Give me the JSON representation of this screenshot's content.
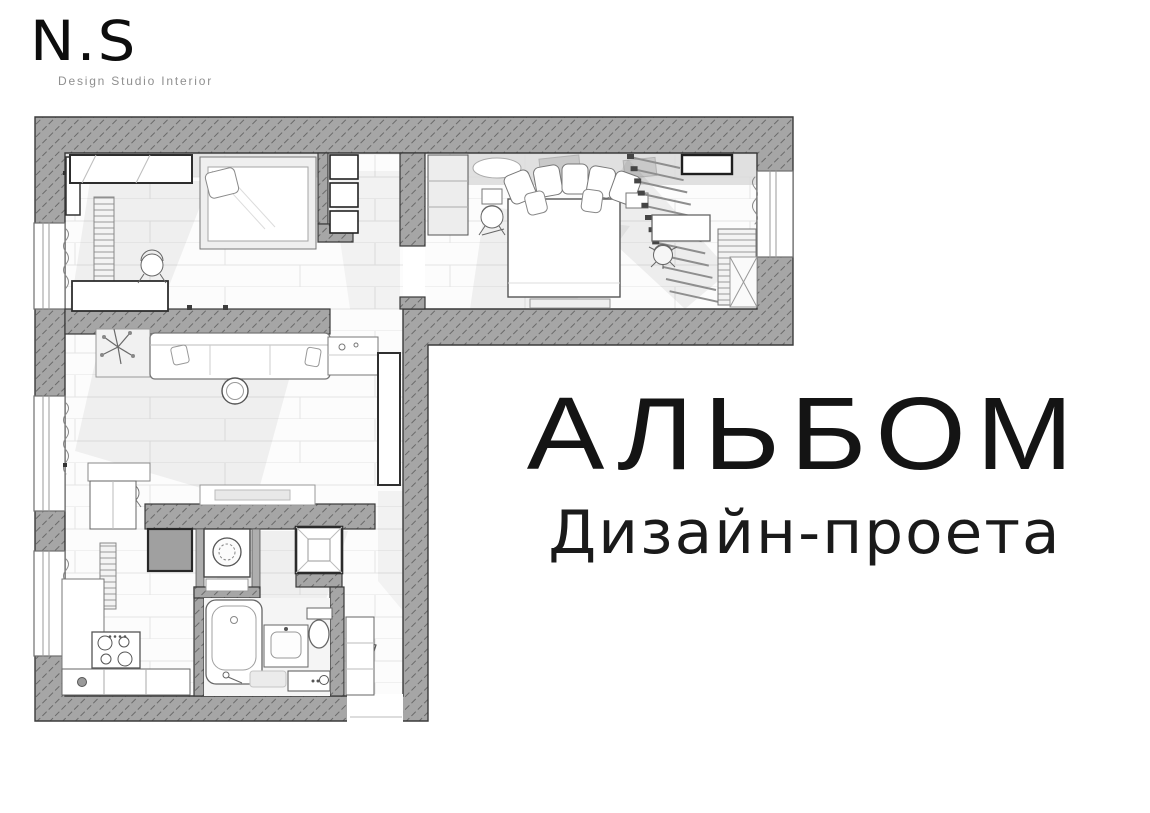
{
  "page": {
    "background_color": "#ffffff",
    "text_color": "#141414"
  },
  "logo": {
    "mark": "N.S",
    "tagline": "Design Studio Interior"
  },
  "cover": {
    "title": "АЛЬБОМ",
    "subtitle": "Дизайн-проета"
  },
  "floor_plan": {
    "type": "rendered top-down plan of an L-shaped apartment",
    "colors": {
      "wall_fill": "#a6a6a6",
      "wall_hatch": "#6a6a6a",
      "wall_outline": "#3a3a3a",
      "floor": "#fcfcfc",
      "plank_line": "#e4e4e4",
      "furniture_outline": "#777777",
      "soft_shadow": "#e9e9e9",
      "dark_unit": "#a0a0a0"
    },
    "rooms": [
      "kids-room",
      "storage-niche",
      "bedroom",
      "living-room",
      "kitchen",
      "bathroom",
      "hallway"
    ],
    "furniture": [
      "wardrobe",
      "bed",
      "pillows",
      "louver-screen",
      "desk",
      "office-chair",
      "shelf-unit",
      "sofa",
      "plant",
      "coffee-table",
      "tv-panel",
      "media-console",
      "kitchen-counter",
      "cooktop",
      "washing-machine",
      "vent-shaft",
      "bathtub",
      "sink-vanity",
      "toilet",
      "entry-console",
      "radiator",
      "windows",
      "entrance-door"
    ]
  }
}
